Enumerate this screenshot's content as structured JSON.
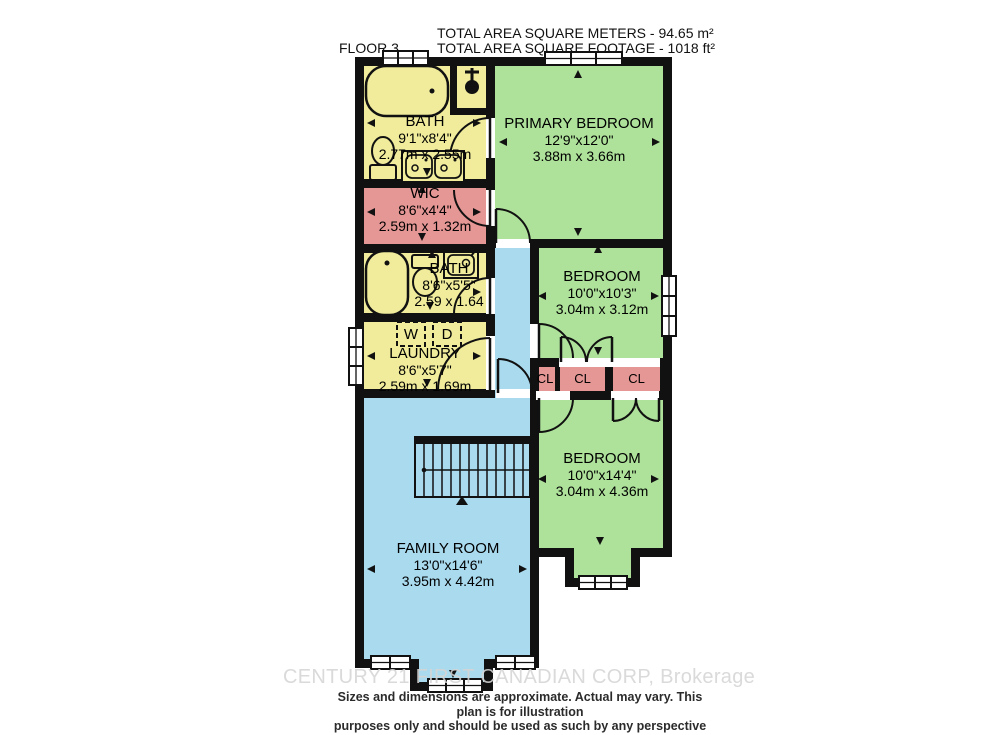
{
  "header": {
    "floor_label": "FLOOR 3",
    "total_area_metric": "TOTAL AREA SQUARE METERS - 94.65 m²",
    "total_area_imperial": "TOTAL AREA SQUARE FOOTAGE - 1018 ft²"
  },
  "rooms": {
    "bath_main": {
      "name": "BATH",
      "imperial": "9'1\"x8'4\"",
      "metric": "2.77m x 2.55m"
    },
    "primary_bedroom": {
      "name": "PRIMARY BEDROOM",
      "imperial": "12'9\"x12'0\"",
      "metric": "3.88m x 3.66m"
    },
    "wic": {
      "name": "WIC",
      "imperial": "8'6\"x4'4\"",
      "metric": "2.59m x 1.32m"
    },
    "bath_second": {
      "name": "BATH",
      "imperial": "8'6\"x5'5\"",
      "metric": "2.59 x 1.64"
    },
    "laundry": {
      "name": "LAUNDRY",
      "imperial": "8'6\"x5'7\"",
      "metric": "2.59m x 1.69m"
    },
    "bedroom_middle": {
      "name": "BEDROOM",
      "imperial": "10'0\"x10'3\"",
      "metric": "3.04m x 3.12m"
    },
    "bedroom_back": {
      "name": "BEDROOM",
      "imperial": "10'0\"x14'4\"",
      "metric": "3.04m x 4.36m"
    },
    "family_room": {
      "name": "FAMILY ROOM",
      "imperial": "13'0\"x14'6\"",
      "metric": "3.95m x 4.42m"
    }
  },
  "closets": {
    "cl1": "CL",
    "cl2": "CL",
    "cl3": "CL"
  },
  "laundry_appliances": {
    "washer": "W",
    "dryer": "D"
  },
  "footer": {
    "watermark": "CENTURY 21 FIRST CANADIAN CORP, Brokerage",
    "disclaimer_line1": "Sizes and dimensions are approximate. Actual may vary. This plan is for illustration",
    "disclaimer_line2": "purposes only and should be used as such by any perspective purchaser."
  },
  "colors": {
    "room_yellow": "#f0ec9b",
    "room_green": "#aee29a",
    "room_pink": "#e59795",
    "room_blue": "#a9daee",
    "wall": "#111111"
  }
}
